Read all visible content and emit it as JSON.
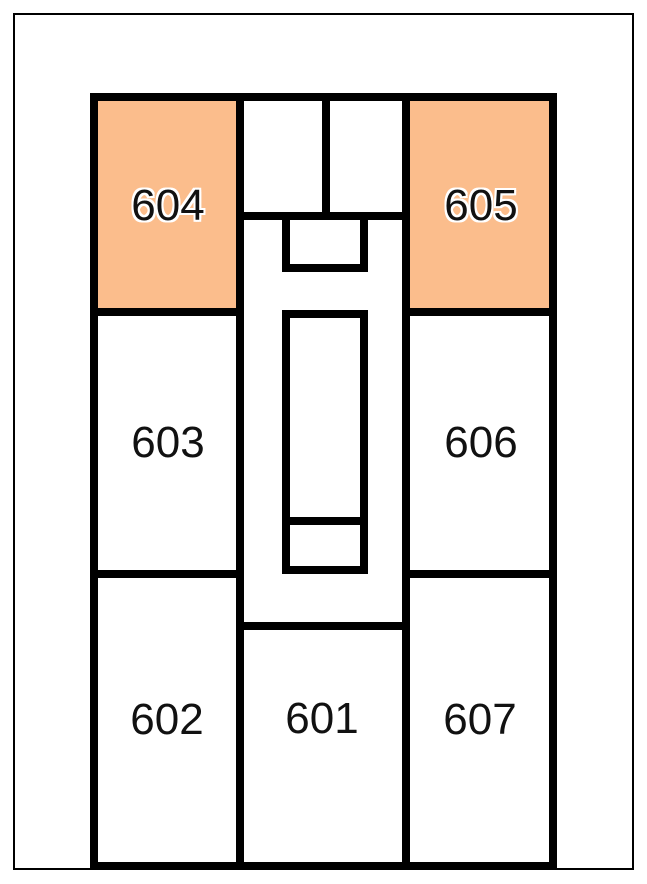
{
  "colors": {
    "background": "#ffffff",
    "frame_border": "#000000",
    "wall": "#000000",
    "room_fill": "#ffffff",
    "highlight_fill": "#FBBD8C",
    "label_text": "#111111"
  },
  "floorplan": {
    "rooms": [
      {
        "number": "601",
        "highlighted": false
      },
      {
        "number": "602",
        "highlighted": false
      },
      {
        "number": "603",
        "highlighted": false
      },
      {
        "number": "604",
        "highlighted": true
      },
      {
        "number": "605",
        "highlighted": true
      },
      {
        "number": "606",
        "highlighted": false
      },
      {
        "number": "607",
        "highlighted": false
      }
    ],
    "highlighted_rooms": [
      "604",
      "605"
    ]
  }
}
